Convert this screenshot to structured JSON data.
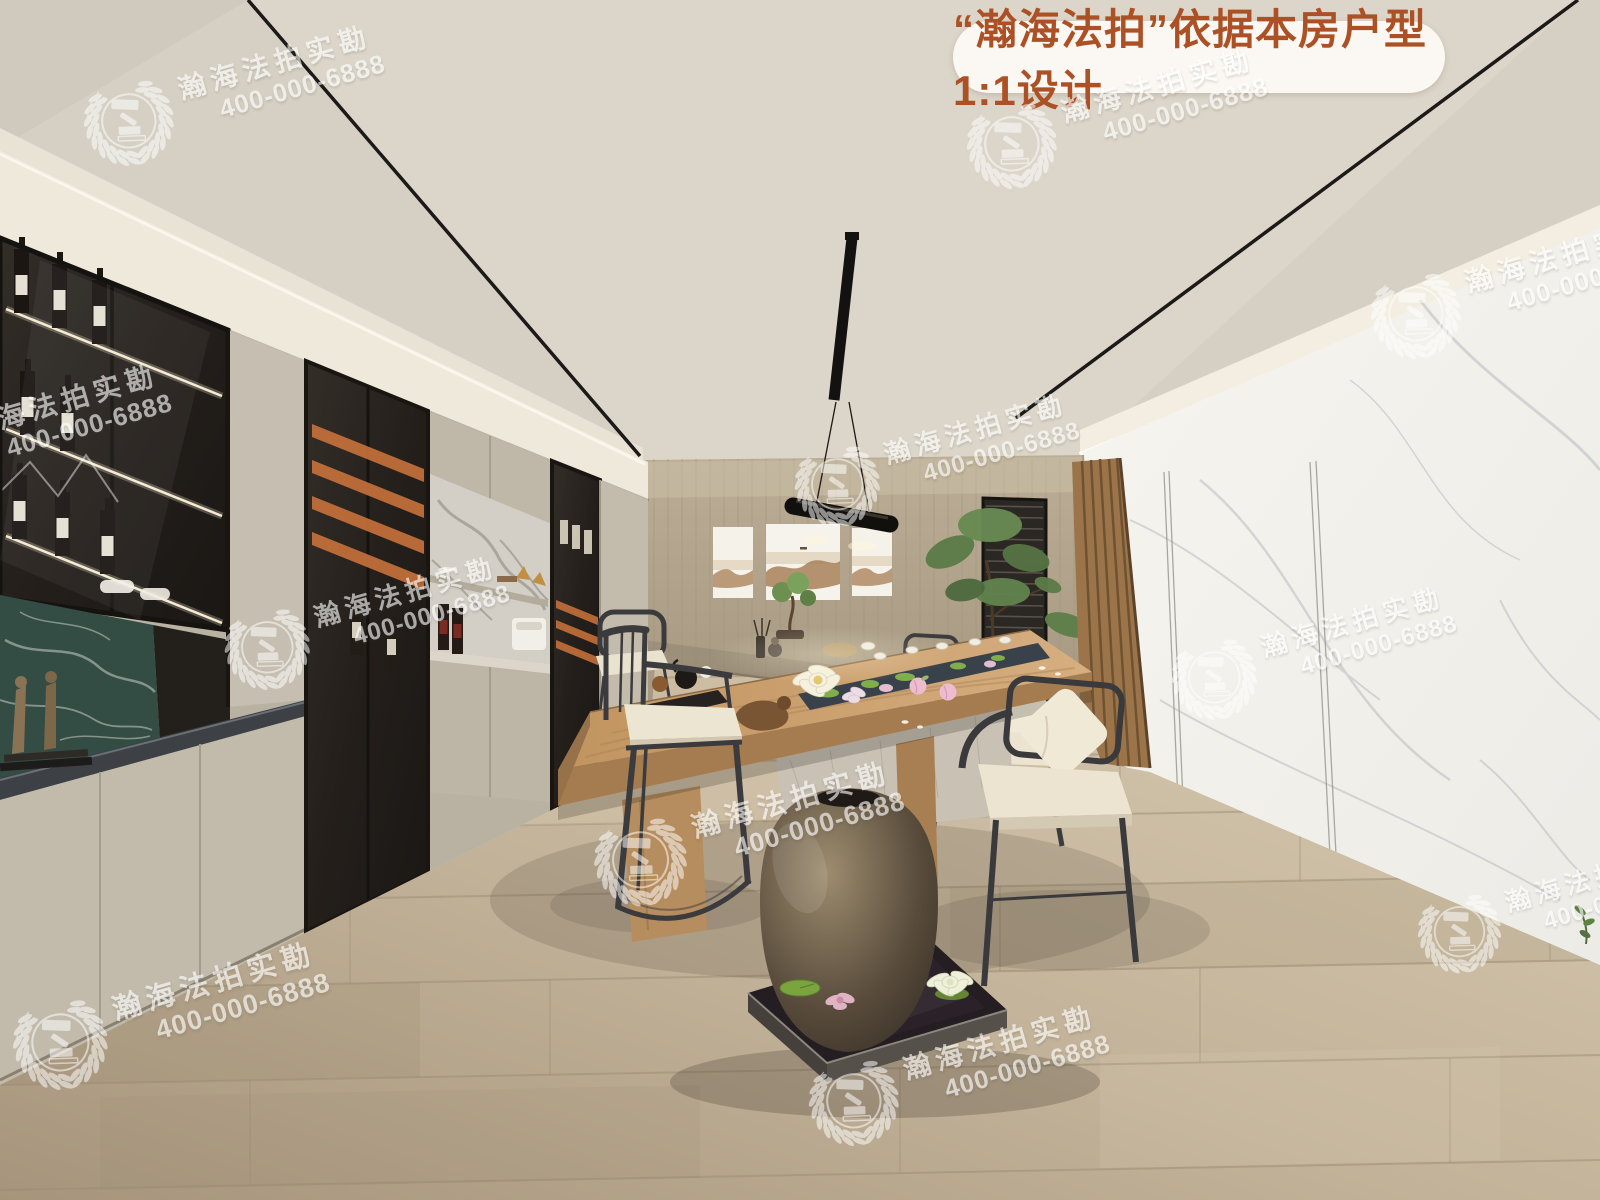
{
  "banner": {
    "text": "“瀚海法拍”依据本房户型1:1设计",
    "text_color": "#ac5125",
    "bg_color": "rgba(253,251,246,0.93)"
  },
  "watermark": {
    "brand": "瀚海法拍实勘",
    "phone": "400-000-6888",
    "logo_icon": "gavel-wreath-icon",
    "color": "#ffffff",
    "repeat_count": 11
  },
  "palette": {
    "ceiling": "#d6d0c4",
    "back_wall_wood": "#b2a58e",
    "marble_wall": "#f2f0ea",
    "floor_wood": "#c2b39c",
    "cabinet_greige": "#c6bfb1",
    "glass_cabinet": "#27231f",
    "accent_orange": "#c4703a",
    "green_marble": "#3d5a50",
    "table_wood": "#c49a6c",
    "cushion_cream": "#ece5d1",
    "frame_black": "#1c1a18"
  }
}
